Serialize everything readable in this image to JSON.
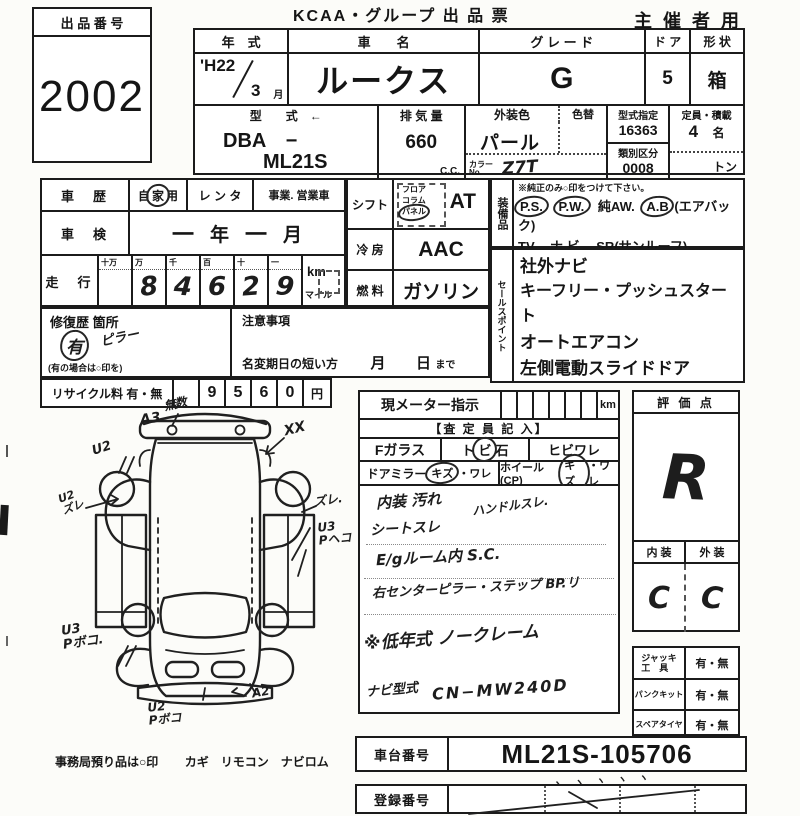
{
  "header": {
    "lot_label": "出 品 番 号",
    "lot_number": "2002",
    "title": "KCAA・グループ 出 品 票",
    "audience": "主 催 者 用"
  },
  "vehicle": {
    "year_label": "年　式",
    "year": "'H22",
    "month": "3",
    "month_unit": "月",
    "name_label": "車　　名",
    "name": "ルークス",
    "grade_label": "グ レ ー ド",
    "grade": "G",
    "door_label": "ド ア",
    "doors": "5",
    "shape_label": "形 状",
    "shape": "箱",
    "model_label": "型　　式　←",
    "model_line1": "DBA　−",
    "model_line2": "ML21S",
    "disp_label": "排 気 量",
    "disp": "660",
    "disp_unit": "C.C.",
    "color_label": "外装色",
    "color": "パール",
    "color_change_label": "色替",
    "color_no_label": "カラー\nNo.",
    "color_no": "Z7T",
    "type_code_label": "型式指定",
    "type_code": "16363",
    "class_label": "類別区分",
    "class_code": "0008",
    "cap_label": "定員・積載",
    "cap": "4",
    "cap_unit": "名",
    "load_unit": "トン"
  },
  "history": {
    "label": "車　歴",
    "private_pre": "自",
    "private_circ": "家",
    "private_post": "用",
    "rental": "レ ン タ",
    "business": "事業. 営業車",
    "inspection_label": "車　検",
    "insp_year": "一",
    "insp_year_unit": "年",
    "insp_month": "一",
    "insp_month_unit": "月",
    "mileage_label": "走　行",
    "odo_headers": [
      "十万",
      "万",
      "千",
      "百",
      "十",
      "一"
    ],
    "odo_digits": [
      "",
      "8",
      "4",
      "6",
      "2",
      "9"
    ],
    "unit_km": "km",
    "unit_mile": "マイル"
  },
  "repair": {
    "label": "修復歴 箇所",
    "mark": "有",
    "location": "ピラー",
    "note": "(有の場合は○印を)",
    "caution_label": "注意事項",
    "rename_label": "名変期日の短い方",
    "rename_month": "月",
    "rename_day": "日",
    "rename_suffix": "まで"
  },
  "recycle": {
    "label": "リサイクル料 有・無",
    "digits": [
      "",
      "9",
      "5",
      "6",
      "0"
    ],
    "unit": "円"
  },
  "drivetrain": {
    "shift_label": "シフト",
    "shift_opt1": "フロア",
    "shift_opt2": "コラム",
    "shift_opt3": "パネル",
    "shift": "AT",
    "ac_label": "冷 房",
    "ac": "AAC",
    "fuel_label": "燃 料",
    "fuel": "ガソリン"
  },
  "equipment": {
    "label": "装備品",
    "note": "※純正のみ○印をつけて下さい。",
    "ps": "P.S.",
    "pw": "P.W.",
    "aw": "純AW.",
    "ab": "A.B",
    "ab_note": "(エアバック)",
    "line2": "TV.　ナ ビ.　SR(サンルーフ)",
    "warranty": "新車保証書←",
    "warranty_note": "(注) 後日送りのみ"
  },
  "sales": {
    "label": "セールスポイント",
    "items": [
      "社外ナビ",
      "キーフリー・プッシュスタート",
      "オートエアコン",
      "左側電動スライドドア"
    ]
  },
  "diagram": {
    "ann_a3": "A3",
    "ann_scribble": "無数",
    "ann_xx": "XX",
    "ann_u2": "U2",
    "ann_u2zure": "U2\nズレ",
    "ann_zure": "ズレ.",
    "ann_u3p": "U3\nPヘコ",
    "ann_u3b": "U3\nPボコ.",
    "ann_u2b": "U2\nPボコ",
    "ann_a2": "A2",
    "custody": "事務局預り品は○印",
    "custody_items": "カギ　リモコン　ナビロム"
  },
  "meter": {
    "label": "現メーター指示",
    "unit": "km",
    "inspector": "【査 定 員 記 入】",
    "fglass_label": "Fガラス",
    "fg_a": "ト",
    "fg_b": "ビ",
    "fg_c": "石",
    "fg_opt2": "ヒビワレ",
    "mirror_label": "ドアミラー",
    "mirror_opt_a": "キズ",
    "mirror_opt_b": "・ワレ",
    "wheel_label": "ホイール(CP)",
    "wheel_opt_a": "キズ",
    "wheel_opt_b": "・ワレ"
  },
  "notes": {
    "l1a": "内装 汚れ",
    "l1b": "ハンドルスレ.",
    "l2": "シートスレ",
    "l3": "E/gルーム内 S.C.",
    "l4": "右センターピラー・ステップ BP.リ",
    "l5": "※低年式 ノークレーム",
    "navi_label": "ナビ型式",
    "navi": "CN−MW240D"
  },
  "evaluation": {
    "label": "評 価 点",
    "score": "R",
    "int_label": "内 装",
    "ext_label": "外 装",
    "interior": "C",
    "exterior": "C"
  },
  "tools": {
    "jack": "ジャッキ\n工　具",
    "puncture": "パンクキット",
    "spare": "スペアタイヤ",
    "value": "有・無"
  },
  "footer": {
    "vin_label": "車台番号",
    "vin": "ML21S-105706",
    "ticks": "ヽ ヽ ヽ ヽ ヽ",
    "reg_label": "登録番号"
  }
}
